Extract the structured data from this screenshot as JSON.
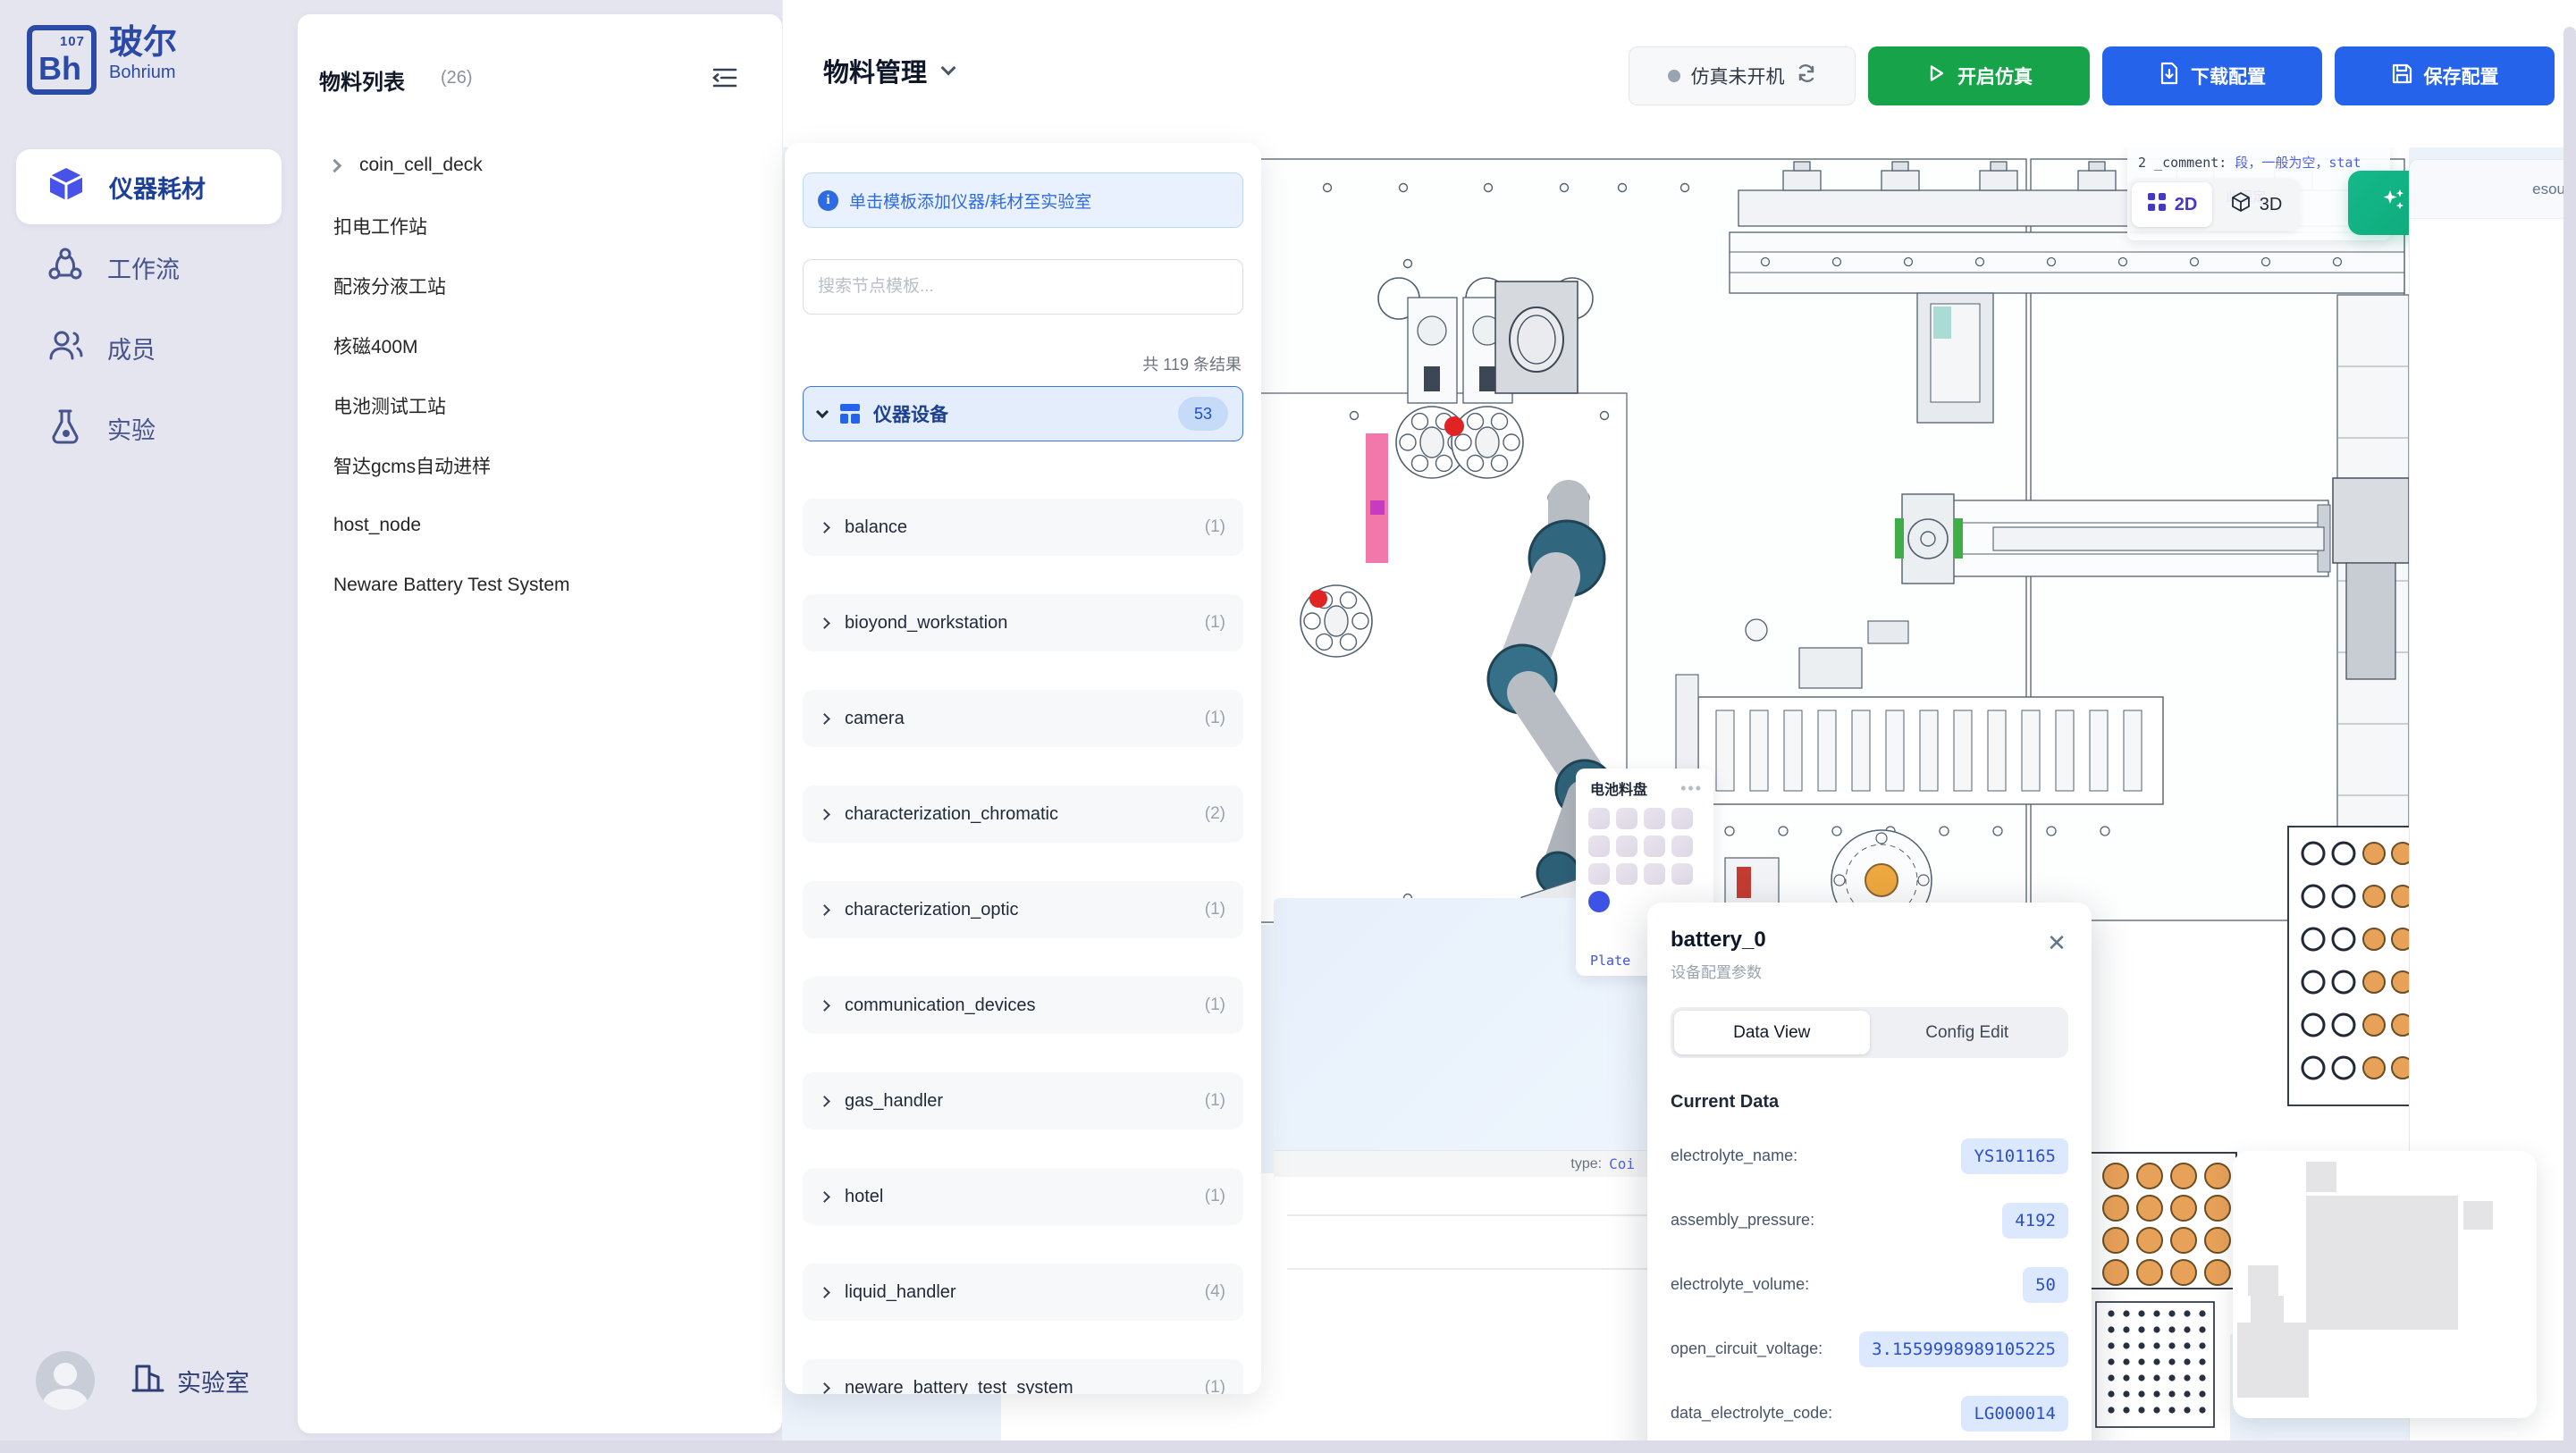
{
  "sidebar": {
    "logo": {
      "symbol": "Bh",
      "number": "107",
      "title": "玻尔",
      "subtitle": "Bohrium"
    },
    "items": [
      {
        "label": "仪器耗材",
        "icon": "cube-icon",
        "active": true
      },
      {
        "label": "工作流",
        "icon": "workflow-icon",
        "active": false
      },
      {
        "label": "成员",
        "icon": "members-icon",
        "active": false
      },
      {
        "label": "实验",
        "icon": "experiment-icon",
        "active": false
      }
    ],
    "footer": {
      "label": "实验室",
      "icon": "building-icon"
    }
  },
  "materials_panel": {
    "title": "物料列表",
    "count": "(26)",
    "items": [
      {
        "label": "coin_cell_deck",
        "expandable": true
      },
      {
        "label": "扣电工作站"
      },
      {
        "label": "配液分液工站"
      },
      {
        "label": "核磁400M"
      },
      {
        "label": "电池测试工站"
      },
      {
        "label": "智达gcms自动进样"
      },
      {
        "label": "host_node"
      },
      {
        "label": "Neware Battery Test System"
      }
    ]
  },
  "topbar": {
    "title": "物料管理",
    "status_label": "仿真未开机",
    "start_label": "开启仿真",
    "download_label": "下载配置",
    "save_label": "保存配置"
  },
  "template_panel": {
    "hint": "单击模板添加仪器/耗材至实验室",
    "search_placeholder": "搜索节点模板...",
    "result_count": "共 119 条结果",
    "group": {
      "label": "仪器设备",
      "badge": "53"
    },
    "categories": [
      {
        "label": "balance",
        "count": "(1)"
      },
      {
        "label": "bioyond_workstation",
        "count": "(1)"
      },
      {
        "label": "camera",
        "count": "(1)"
      },
      {
        "label": "characterization_chromatic",
        "count": "(2)"
      },
      {
        "label": "characterization_optic",
        "count": "(1)"
      },
      {
        "label": "communication_devices",
        "count": "(1)"
      },
      {
        "label": "gas_handler",
        "count": "(1)"
      },
      {
        "label": "hotel",
        "count": "(1)"
      },
      {
        "label": "liquid_handler",
        "count": "(4)"
      },
      {
        "label": "neware_battery_test_system",
        "count": "(1)"
      }
    ]
  },
  "canvas": {
    "toggle": {
      "d2": "2D",
      "d3": "3D"
    },
    "beautify_label": "美化布局",
    "tooltip": {
      "prefix": "2",
      "key": "_comment:",
      "value": "段，一般为空，stat",
      "line2": "此固定"
    },
    "tray_card": {
      "title": "电池料盘",
      "menu": "•••",
      "chip": "Plate"
    },
    "node_footer": {
      "key": "type:",
      "value": "Coi"
    },
    "right_panel_text": "esou"
  },
  "popup": {
    "title": "battery_0",
    "subtitle": "设备配置参数",
    "close": "✕",
    "tabs": [
      {
        "label": "Data View",
        "active": true
      },
      {
        "label": "Config Edit",
        "active": false
      }
    ],
    "section_title": "Current Data",
    "rows": [
      {
        "label": "electrolyte_name:",
        "value": "YS101165"
      },
      {
        "label": "assembly_pressure:",
        "value": "4192"
      },
      {
        "label": "electrolyte_volume:",
        "value": "50"
      },
      {
        "label": "open_circuit_voltage:",
        "value": "3.1559998989105225"
      },
      {
        "label": "data_electrolyte_code:",
        "value": "LG000014"
      }
    ]
  },
  "colors": {
    "accent_blue": "#2563eb",
    "accent_green": "#16a34a",
    "beautify_green": "#0fae7d",
    "sidebar_bg": "#e5e5f0",
    "canvas_bg": "#ebf2fa",
    "value_pill_bg": "#dce8fd",
    "value_pill_text": "#2b50c9"
  }
}
